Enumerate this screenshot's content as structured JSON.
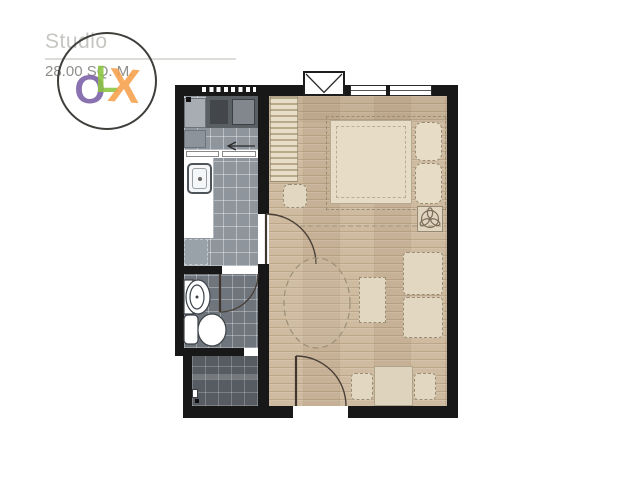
{
  "header": {
    "title": "Studio",
    "area": "28.00 SQ. M."
  },
  "watermark": {
    "letters": [
      {
        "char": "O",
        "color": "#7b5fa6"
      },
      {
        "char": "L",
        "color": "#8cc63f"
      },
      {
        "char": "X",
        "color": "#f5a04c"
      }
    ],
    "circle_color": "#3e3e3b"
  },
  "colors": {
    "background": "#ffffff",
    "wall": "#181818",
    "kitchen_tile": "#8e959d",
    "bathroom_tile": "#6f757c",
    "balcony_tile": "#575c62",
    "wood_floor": "#ccb79b",
    "bed_fill": "#e7ddc7",
    "furniture_fill": "#e2d8c2",
    "counter_white": "#ffffff",
    "appliance_gray": "#5a5f64",
    "title_text": "#c6c6c2",
    "area_text": "#8e8e8a",
    "divider_line": "#dcdcd8"
  }
}
